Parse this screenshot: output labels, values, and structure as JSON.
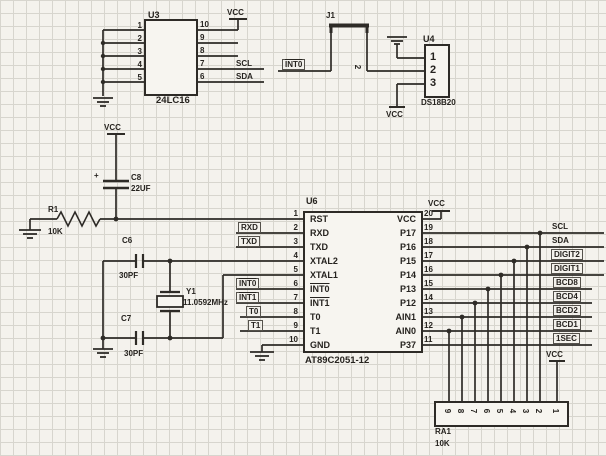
{
  "style": {
    "ink": "#2e2b27",
    "paper": "#f4f2ed"
  },
  "u3": {
    "ref": "U3",
    "part": "24LC16",
    "vcc": "VCC",
    "pins_left": [
      "1",
      "2",
      "3",
      "4",
      "5"
    ],
    "pins_right": [
      "10",
      "9",
      "8",
      "7",
      "6"
    ],
    "net_scl": "SCL",
    "net_sda": "SDA"
  },
  "sensor": {
    "j1": "J1",
    "j1_pin": "2",
    "int0": "INT0",
    "u4": "U4",
    "part": "DS18B20",
    "pins": [
      "1",
      "2",
      "3"
    ],
    "vcc": "VCC"
  },
  "reset": {
    "vcc": "VCC",
    "plus": "+",
    "c8": "C8",
    "c8_val": "22UF",
    "r1": "R1",
    "r1_val": "10K"
  },
  "osc": {
    "c6": "C6",
    "c6_val": "30PF",
    "c7": "C7",
    "c7_val": "30PF",
    "y1": "Y1",
    "y1_val": "11.0592MHz"
  },
  "u6": {
    "ref": "U6",
    "part": "AT89C2051-12",
    "vcc": "VCC",
    "left": [
      {
        "num": "1",
        "name": "RST"
      },
      {
        "num": "2",
        "name": "RXD"
      },
      {
        "num": "3",
        "name": "TXD"
      },
      {
        "num": "4",
        "name": "XTAL2"
      },
      {
        "num": "5",
        "name": "XTAL1"
      },
      {
        "num": "6",
        "name": "INT0"
      },
      {
        "num": "7",
        "name": "INT1"
      },
      {
        "num": "8",
        "name": "T0"
      },
      {
        "num": "9",
        "name": "T1"
      },
      {
        "num": "10",
        "name": "GND"
      }
    ],
    "right": [
      {
        "num": "20",
        "name": "VCC"
      },
      {
        "num": "19",
        "name": "P17"
      },
      {
        "num": "18",
        "name": "P16"
      },
      {
        "num": "17",
        "name": "P15"
      },
      {
        "num": "16",
        "name": "P14"
      },
      {
        "num": "15",
        "name": "P13"
      },
      {
        "num": "14",
        "name": "P12"
      },
      {
        "num": "13",
        "name": "AIN1"
      },
      {
        "num": "12",
        "name": "AIN0"
      },
      {
        "num": "11",
        "name": "P37"
      }
    ]
  },
  "nets_left": {
    "rxd": "RXD",
    "txd": "TXD",
    "int0": "INT0",
    "int1": "INT1",
    "t0": "T0",
    "t1": "T1"
  },
  "nets_right": [
    "SCL",
    "SDA",
    "DIGIT2",
    "DIGIT1",
    "BCD8",
    "BCD4",
    "BCD2",
    "BCD1",
    "1SEC"
  ],
  "ra1": {
    "ref": "RA1",
    "val": "10K",
    "vcc": "VCC",
    "pins": [
      "9",
      "8",
      "7",
      "6",
      "5",
      "4",
      "3",
      "2",
      "1"
    ]
  }
}
